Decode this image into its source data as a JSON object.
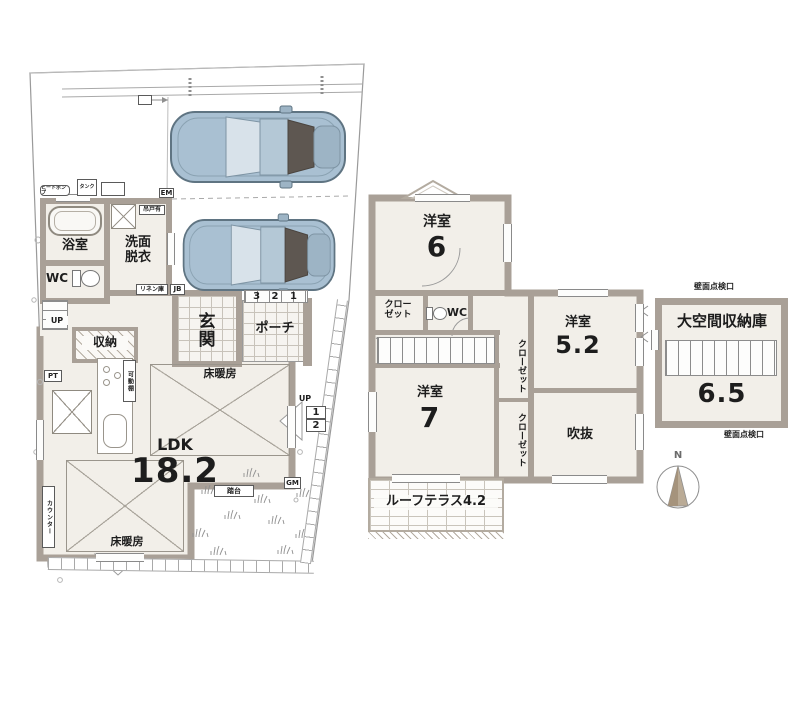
{
  "floor1": {
    "bath": "浴室",
    "washroom": "洗面\n脱衣",
    "wc": "WC",
    "entrance": "玄関",
    "porch": "ポーチ",
    "storage": "収納",
    "ldk": "LDK",
    "ldk_size": "18.2",
    "floor_heating": "床暖房",
    "counter": "カウンター",
    "movable_shelf": "可動棚",
    "pt": "PT",
    "up": "UP",
    "em": "EM",
    "jb": "JB",
    "linen": "リネン庫",
    "hanging_door": "吊戸有",
    "heat_pump": "ヒートポンプ",
    "tank": "タンク",
    "entry_steps": "3 2 1",
    "step1": "1",
    "step2": "2",
    "gm": "GM",
    "stepstool": "踏台"
  },
  "floor2": {
    "room6": "洋室",
    "room6_size": "6",
    "closet_two_line": "クロー\nゼット",
    "closet": "クローゼット",
    "wc": "WC",
    "room52": "洋室",
    "room52_size": "5.2",
    "room7": "洋室",
    "room7_size": "7",
    "void": "吹抜",
    "roof_terrace": "ルーフテラス4.2"
  },
  "attic": {
    "name": "大空間収納庫",
    "size": "6.5",
    "inspection": "壁面点検口"
  },
  "compass": {
    "north": "N"
  },
  "colors": {
    "wall": "#a9a097",
    "room_floor": "#f2efe9",
    "car_body": "#a9c0d2",
    "line": "#9a9a9a"
  }
}
